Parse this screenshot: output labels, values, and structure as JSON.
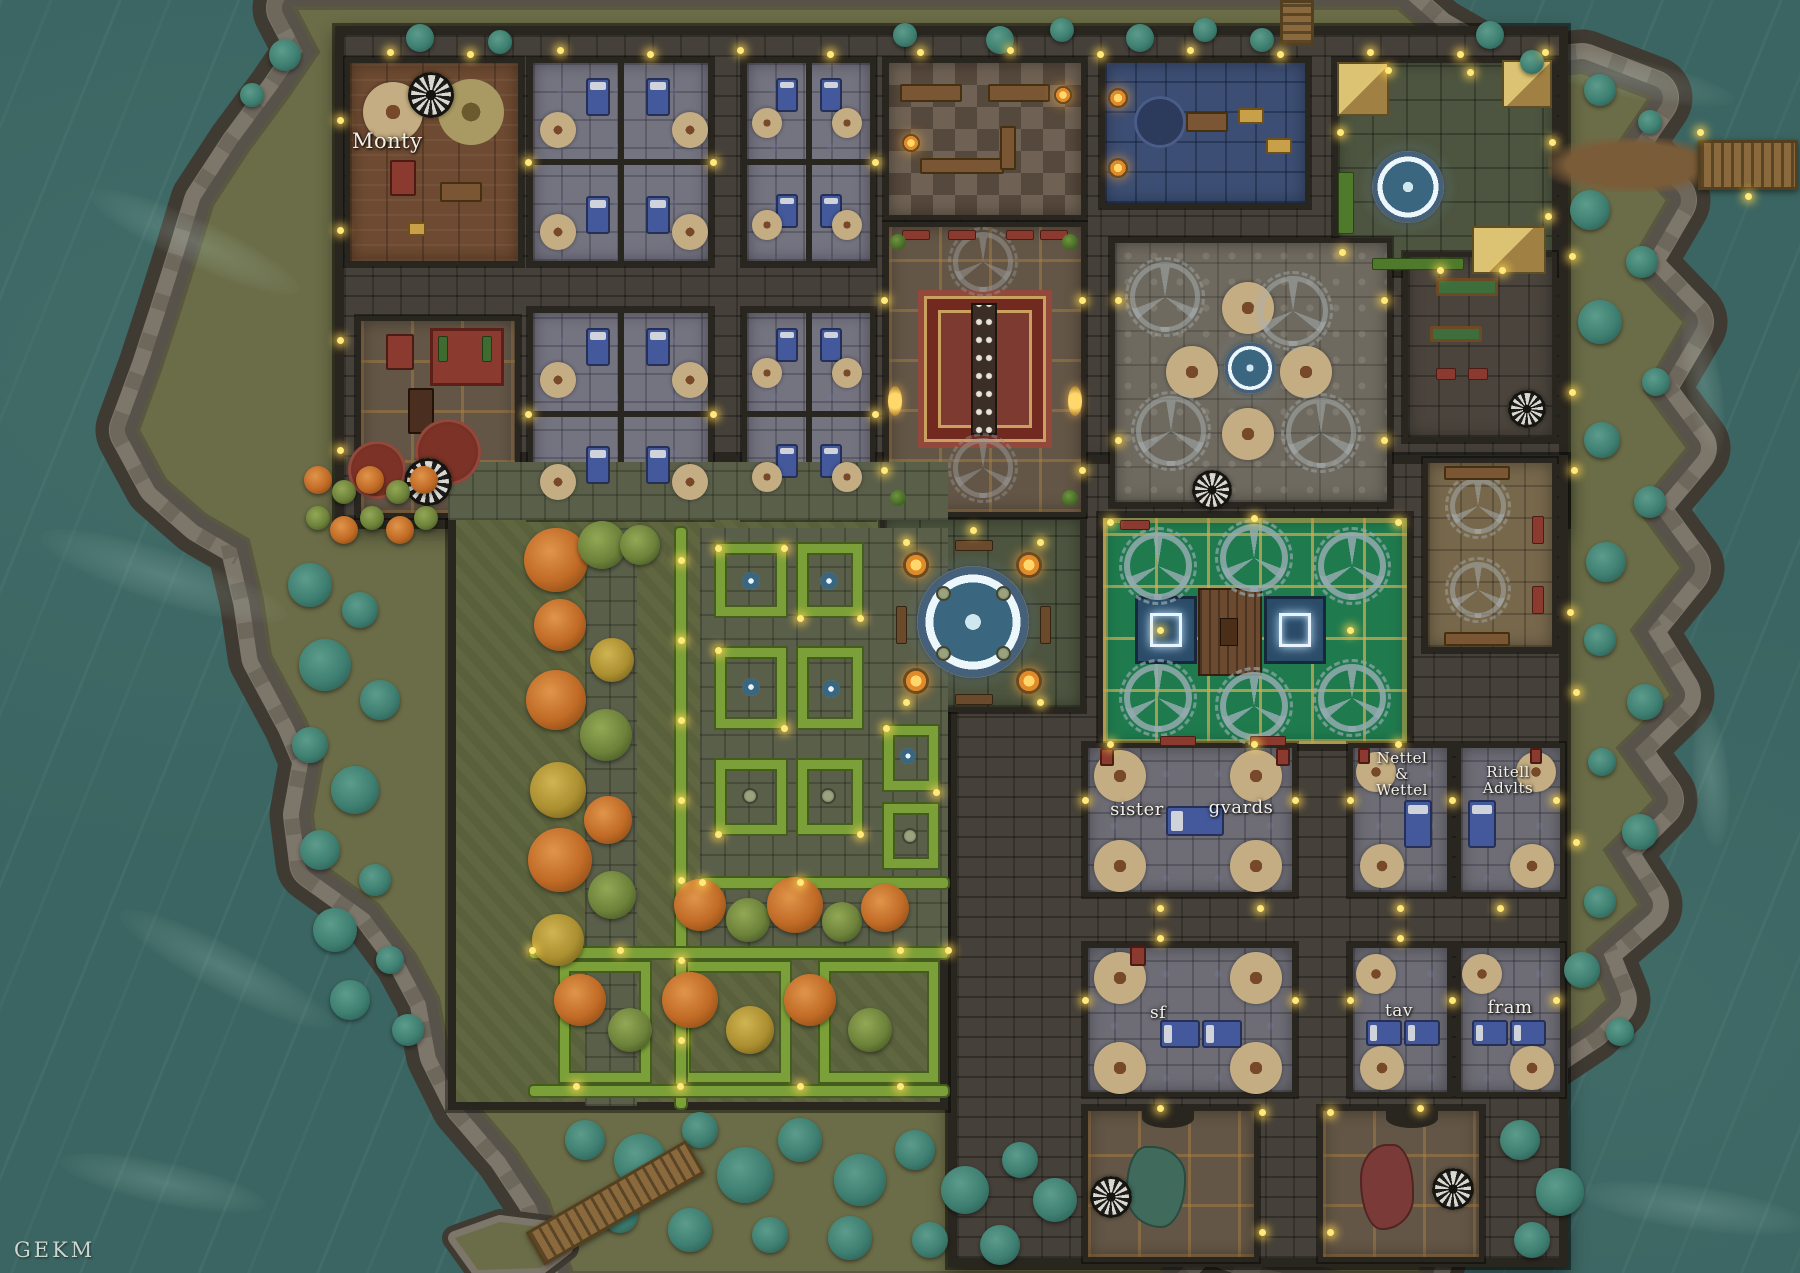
{
  "map": {
    "watermark": "GEKM",
    "rooms": {
      "monty": "Monty",
      "sister": "sister",
      "guards": "gvards",
      "nettel": [
        "Nettel",
        "&",
        "Wettel"
      ],
      "ritell": [
        "Ritell",
        "Advlts"
      ],
      "sf": "sf",
      "tav": "tav",
      "fram": "fram"
    },
    "palette": {
      "water": "#3b6562",
      "grass": "#6b6d48",
      "rock_light": "#7d766a",
      "rock_dark": "#3f3a32",
      "wall": "#29251f",
      "green_court": "#1f7b4e",
      "hedge": "#7ca039",
      "light_glow": "#ffe97a"
    }
  }
}
